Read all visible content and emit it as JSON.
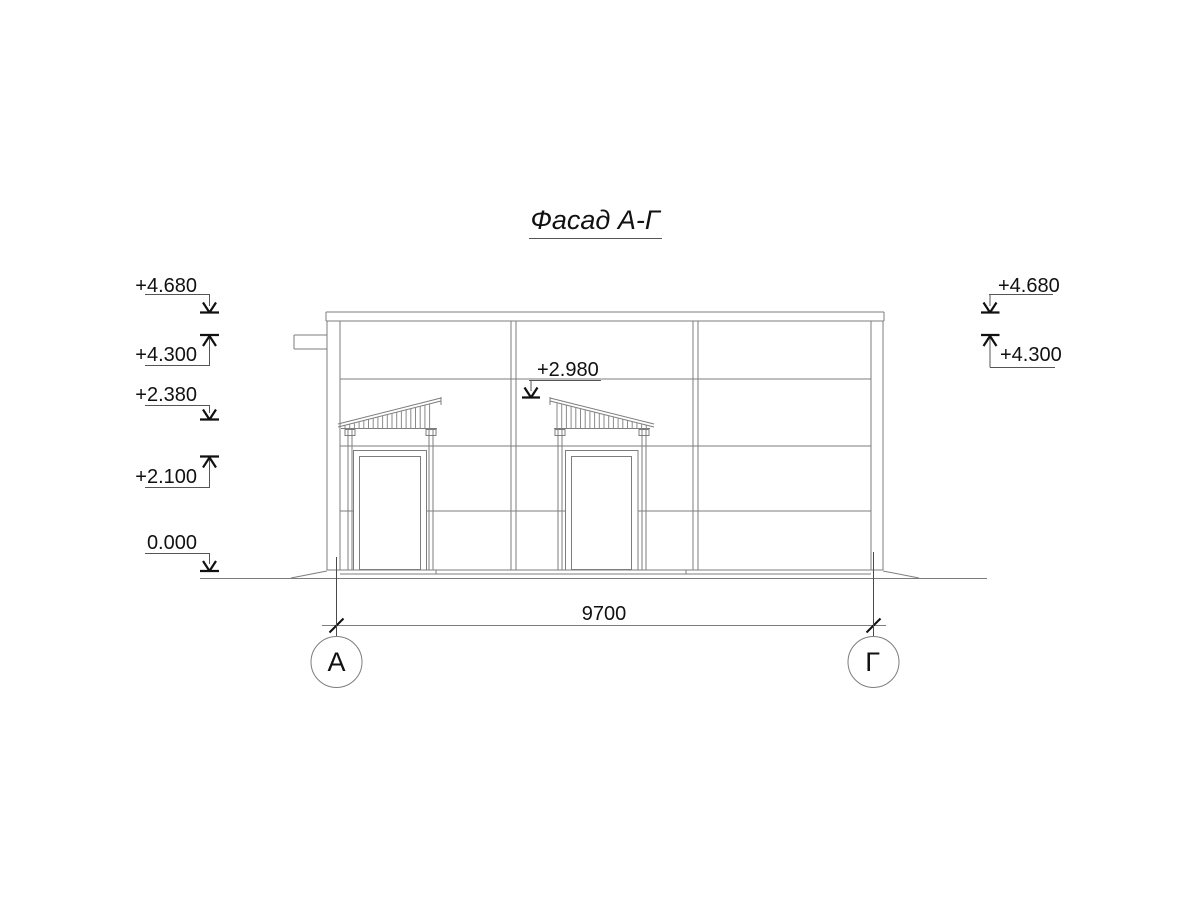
{
  "title": {
    "text": "Фасад А-Г"
  },
  "elevation_marks": {
    "left": [
      {
        "label": "+4.680",
        "direction": "down"
      },
      {
        "label": "+4.300",
        "direction": "up"
      },
      {
        "label": "+2.380",
        "direction": "down"
      },
      {
        "label": "+2.100",
        "direction": "up"
      },
      {
        "label": "0.000",
        "direction": "down"
      }
    ],
    "center": [
      {
        "label": "+2.980",
        "direction": "down"
      }
    ],
    "right": [
      {
        "label": "+4.680",
        "direction": "down"
      },
      {
        "label": "+4.300",
        "direction": "up"
      }
    ]
  },
  "dimension": {
    "value": "9700"
  },
  "axes": {
    "left_label": "А",
    "right_label": "Г"
  },
  "colors": {
    "background": "#ffffff",
    "drawing_line": "#7d7d7d",
    "annotation": "#111111"
  }
}
